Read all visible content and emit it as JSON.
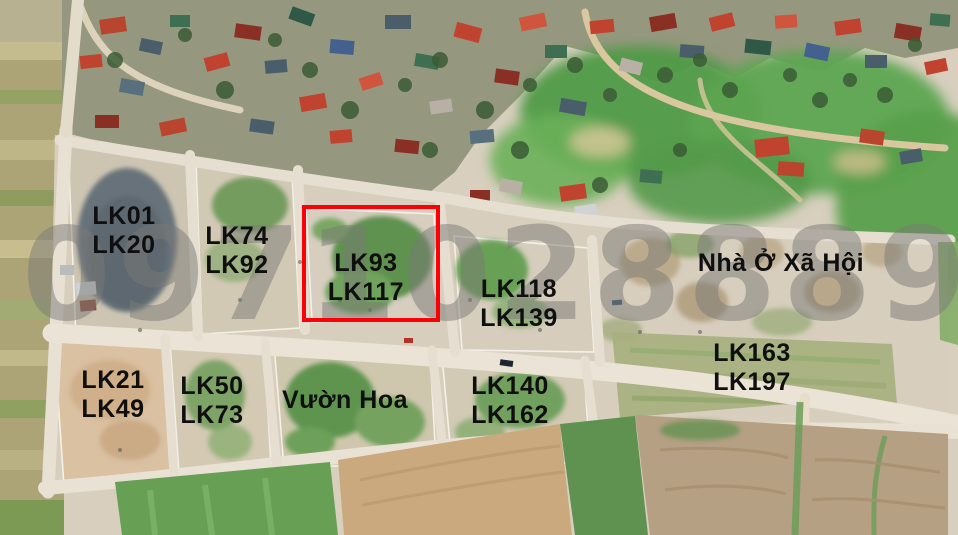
{
  "watermark": {
    "text": "0971028889",
    "color": "#7a7975"
  },
  "highlight": {
    "x": 302,
    "y": 205,
    "width": 138,
    "height": 117,
    "color": "#fb0007",
    "label_lines": [
      "LK93",
      "LK117"
    ]
  },
  "labels": [
    {
      "name": "lk01-lk20",
      "lines": [
        "LK01",
        "LK20"
      ]
    },
    {
      "name": "lk74-lk92",
      "lines": [
        "LK74",
        "LK92"
      ]
    },
    {
      "name": "lk93-lk117",
      "lines": [
        "LK93",
        "LK117"
      ]
    },
    {
      "name": "lk118-lk139",
      "lines": [
        "LK118",
        "LK139"
      ]
    },
    {
      "name": "nha-o-xa-hoi",
      "lines": [
        "Nhà Ở Xã Hội"
      ]
    },
    {
      "name": "lk21-lk49",
      "lines": [
        "LK21",
        "LK49"
      ]
    },
    {
      "name": "lk50-lk73",
      "lines": [
        "LK50",
        "LK73"
      ]
    },
    {
      "name": "vuon-hoa",
      "lines": [
        "Vườn Hoa"
      ]
    },
    {
      "name": "lk140-lk162",
      "lines": [
        "LK140",
        "LK162"
      ]
    },
    {
      "name": "lk163-lk197",
      "lines": [
        "LK163",
        "LK197"
      ]
    }
  ],
  "colors": {
    "label_text": "#0f0f0f",
    "highlight": "#fb0007"
  }
}
